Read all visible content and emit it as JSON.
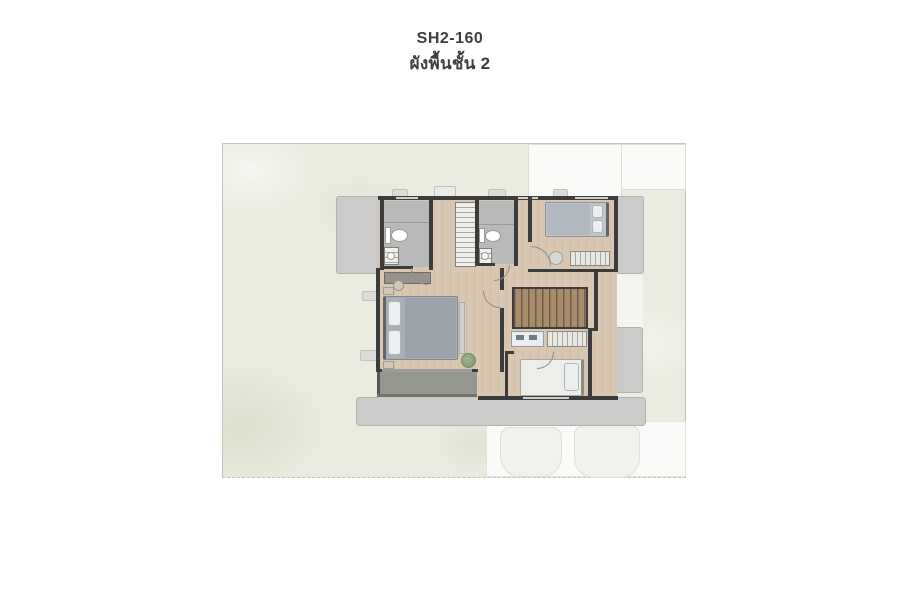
{
  "header": {
    "code": "SH2-160",
    "floor_label": "ผังพื้นชั้น 2"
  },
  "palette": {
    "page_bg": "#ffffff",
    "title_text": "#3e3e3e",
    "lawn": "#e9ecdf",
    "lawn_border": "#c2c5b8",
    "paving": "#fafaf8",
    "roof": "#cbcbc9",
    "roof_border": "#b2b2b0",
    "wall": "#3c3c3c",
    "wood": "#d9c7b2",
    "tile": "#b9b9b9",
    "stairs": "#a68b6d",
    "balcony": "#94978f"
  }
}
